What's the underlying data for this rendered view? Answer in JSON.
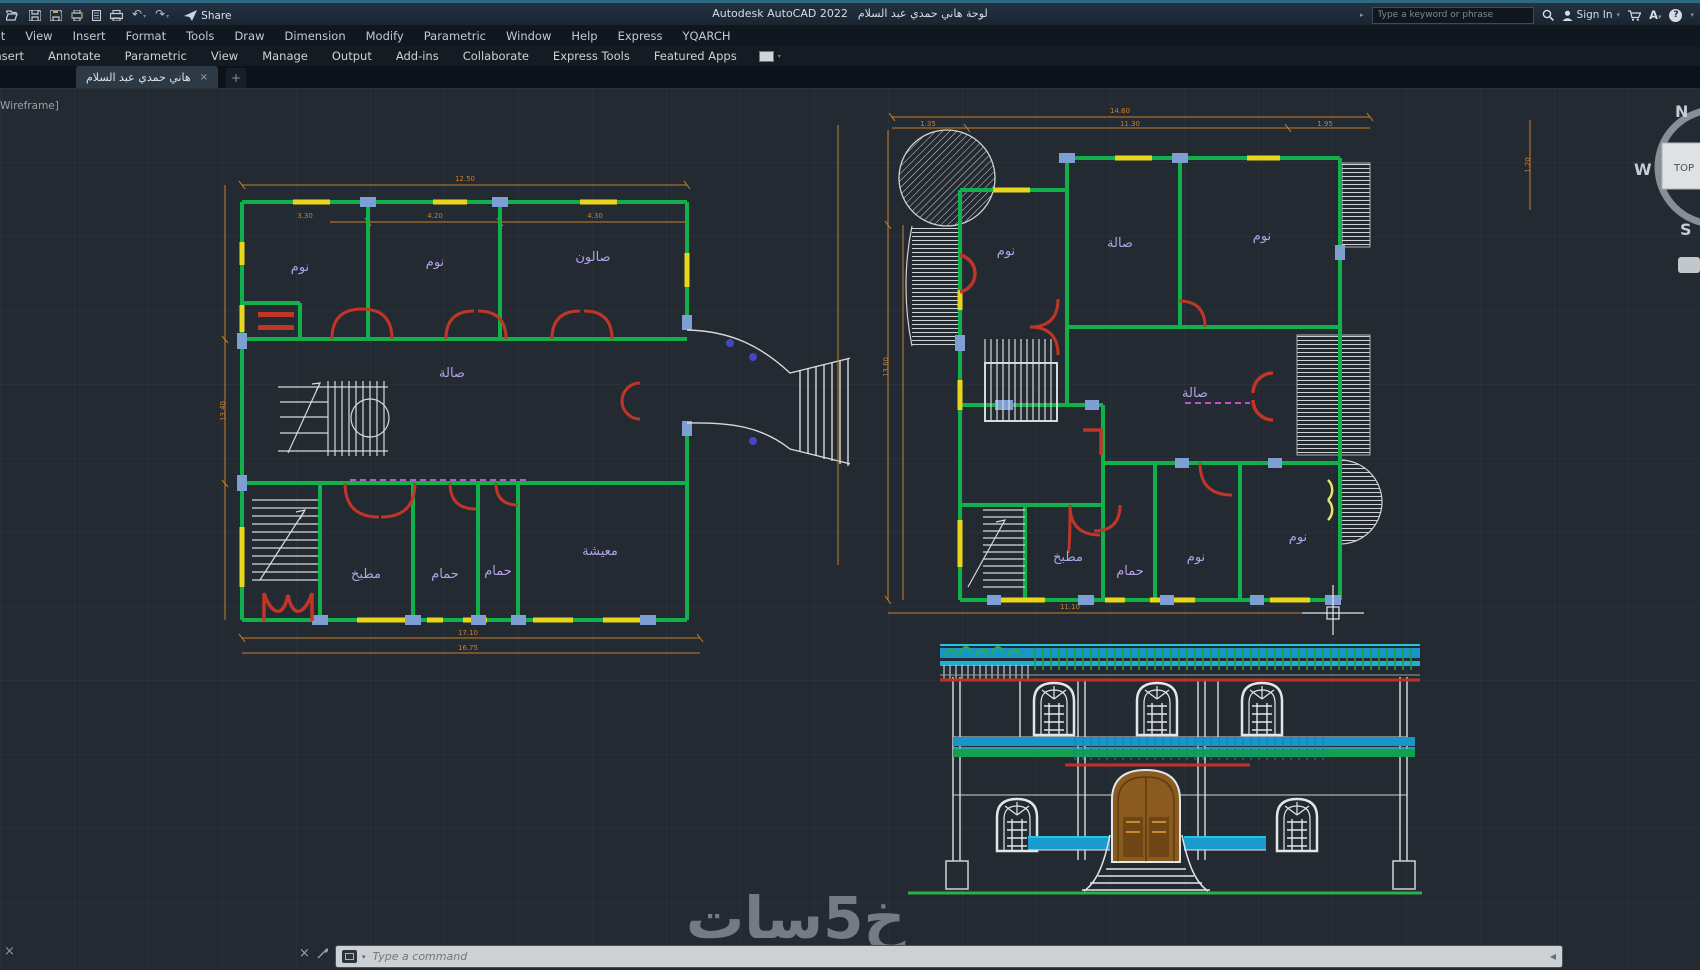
{
  "titlebar": {
    "app_title": "Autodesk AutoCAD 2022",
    "doc_title": "لوحة هاني حمدي عبد السلام",
    "share_label": "Share",
    "search_placeholder": "Type a keyword or phrase",
    "sign_in_label": "Sign In",
    "font_button": "A",
    "help_glyph": "?"
  },
  "menubar": {
    "items": [
      "Edit",
      "View",
      "Insert",
      "Format",
      "Tools",
      "Draw",
      "Dimension",
      "Modify",
      "Parametric",
      "Window",
      "Help",
      "Express",
      "YQARCH"
    ]
  },
  "ribbon": {
    "tabs": [
      "Insert",
      "Annotate",
      "Parametric",
      "View",
      "Manage",
      "Output",
      "Add-ins",
      "Collaborate",
      "Express Tools",
      "Featured Apps"
    ]
  },
  "file_tab": {
    "title": "هاني حمدي عبد السلام",
    "close_glyph": "×",
    "new_tab_glyph": "+"
  },
  "viewport": {
    "style_label": "Wireframe]",
    "viewcube": {
      "north": "N",
      "west": "W",
      "south": "S",
      "top_face": "TOP"
    }
  },
  "plans": {
    "left": {
      "rooms": {
        "bed1": "نوم",
        "bed2": "نوم",
        "salon": "صالون",
        "hall": "صالة",
        "kitchen": "مطبخ",
        "bath1": "حمام",
        "bath2": "حمام",
        "living": "معيشة"
      },
      "dims": {
        "t1": "3.30",
        "t2": "4.20",
        "t3": "4.30",
        "total_top": "12.50",
        "left_side": "13.40",
        "bottom1": "17.10",
        "bottom2": "16.75"
      }
    },
    "right": {
      "rooms": {
        "bed1": "نوم",
        "hall_top": "صالة",
        "bed2": "نوم",
        "hall_mid": "صالة",
        "kitchen": "مطبخ",
        "bath": "حمام",
        "bed3": "نوم",
        "bed4": "نوم"
      },
      "dims": {
        "total_top": "14.60",
        "s1": "1.35",
        "s2": "11.30",
        "s3": "1.95",
        "left_side": "13.60",
        "bottom": "11.10",
        "right_side": "1.20"
      }
    }
  },
  "command_line": {
    "placeholder": "Type a command"
  },
  "watermark": "خ5سات",
  "colors": {
    "wall_green": "#12b04a",
    "window_yellow": "#e8d51c",
    "dimension_orange": "#c9802b",
    "door_red": "#bf3527",
    "room_label_purple": "#b3a2e8",
    "sill_blue": "#7d9fd4",
    "balustrade_cyan": "#1a9bd0",
    "door_brown": "#8a5a1e",
    "ground_green": "#2dae4a"
  }
}
